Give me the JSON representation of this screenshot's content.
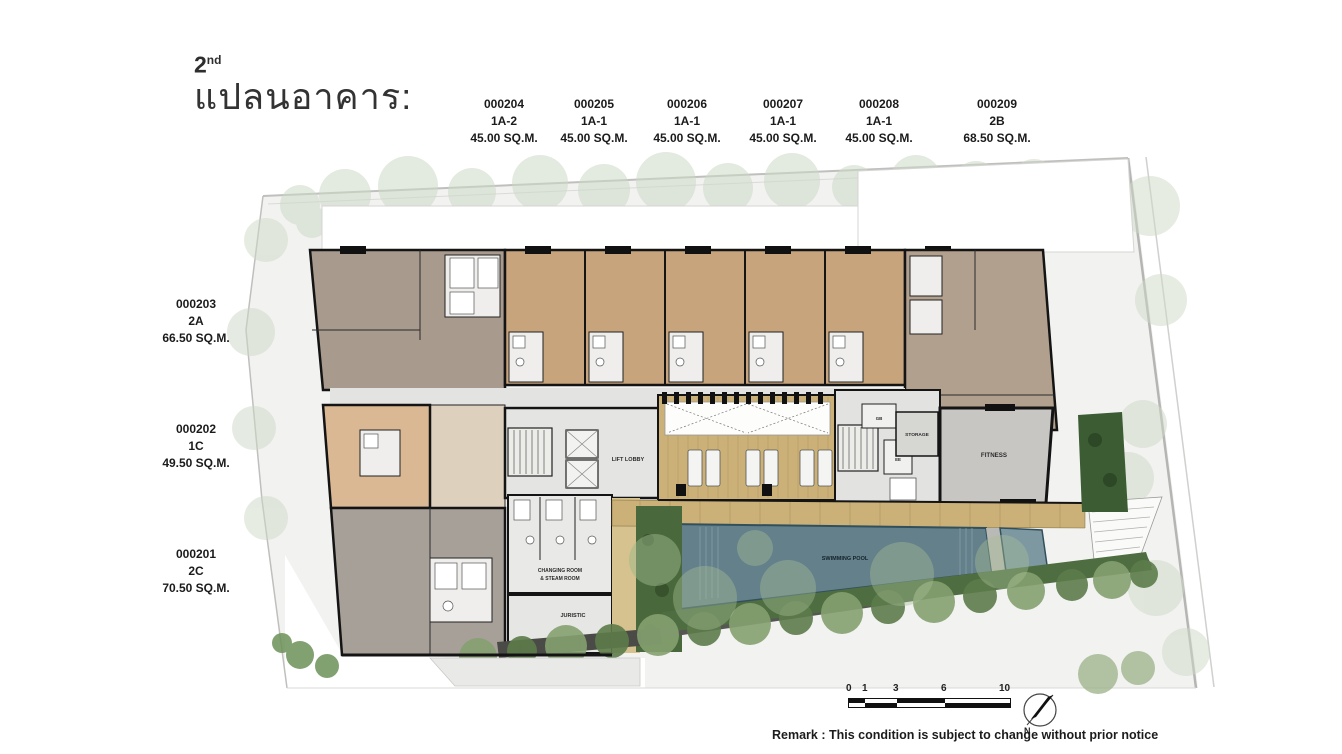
{
  "title": {
    "floor": "2",
    "ordinal": "nd",
    "thai": "แปลนอาคาร:"
  },
  "top_units": [
    {
      "number": "000204",
      "type": "1A-2",
      "area": "45.00 SQ.M."
    },
    {
      "number": "000205",
      "type": "1A-1",
      "area": "45.00 SQ.M."
    },
    {
      "number": "000206",
      "type": "1A-1",
      "area": "45.00 SQ.M."
    },
    {
      "number": "000207",
      "type": "1A-1",
      "area": "45.00 SQ.M."
    },
    {
      "number": "000208",
      "type": "1A-1",
      "area": "45.00 SQ.M."
    },
    {
      "number": "000209",
      "type": "2B",
      "area": "68.50 SQ.M."
    }
  ],
  "left_units": [
    {
      "number": "000203",
      "type": "2A",
      "area": "66.50 SQ.M."
    },
    {
      "number": "000202",
      "type": "1C",
      "area": "49.50 SQ.M."
    },
    {
      "number": "000201",
      "type": "2C",
      "area": "70.50 SQ.M."
    }
  ],
  "rooms": {
    "lift_lobby": "LIFT LOBBY",
    "storage": "STORAGE",
    "fitness": "FITNESS",
    "swimming_pool": "SWIMMING POOL",
    "changing_room_line1": "CHANGING ROOM",
    "changing_room_line2": "& STEAM ROOM",
    "juristic": "JURISTIC",
    "gb": "GB",
    "ee": "EE"
  },
  "scale_bar": {
    "ticks": [
      "0",
      "1",
      "3",
      "6",
      "10"
    ]
  },
  "compass": {
    "label": "N"
  },
  "remark": "Remark : This condition is subject to change without prior notice",
  "colors": {
    "unit_tan": "#c7a47b",
    "unit_2a_gray": "#a89a8d",
    "unit_2b_taupe": "#b1a08e",
    "unit_1c_peach": "#dbb894",
    "unit_2c_gray": "#a7a099",
    "core_gray": "#e4e4e2",
    "deck_wood": "#cbb077",
    "pool_blue": "#63808b",
    "kids_pool_blue": "#7e98a2",
    "hedge_green": "#4e6d41",
    "tree_green": "#86a272",
    "pale_tree_green": "#cdd9c6",
    "fitness_gray": "#c8c6c3",
    "wall_black": "#141414"
  }
}
